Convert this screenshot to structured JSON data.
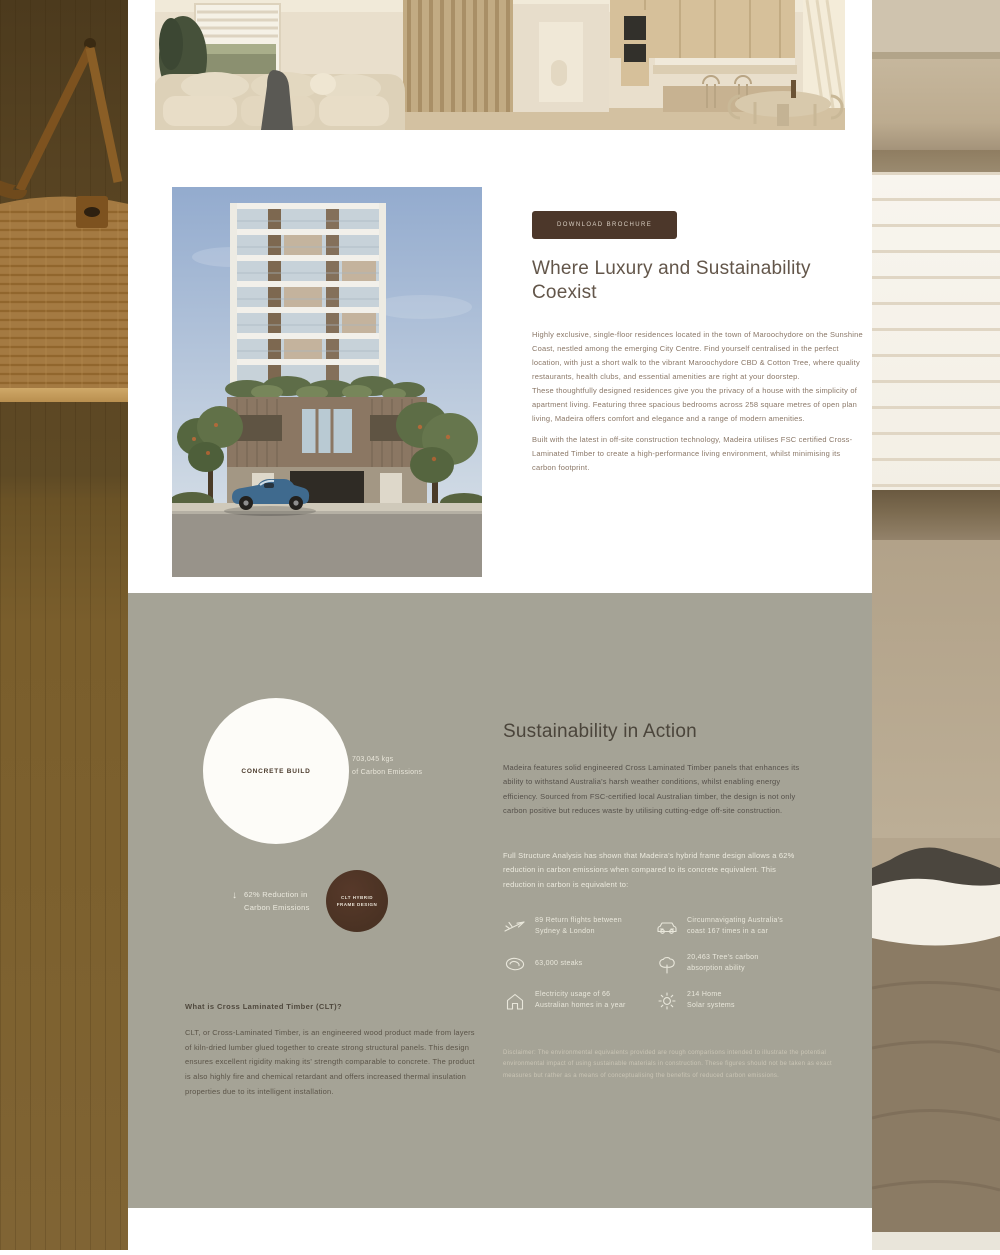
{
  "intro": {
    "button_label": "DOWNLOAD BROCHURE",
    "heading": "Where Luxury and Sustainability Coexist",
    "paragraphs": [
      "Highly exclusive, single-floor residences located in the town of Maroochydore on the Sunshine Coast, nestled among the emerging City Centre. Find yourself centralised in the perfect location, with just a short walk to the vibrant Maroochydore CBD & Cotton Tree, where quality restaurants, health clubs, and essential amenities are right at your doorstep.",
      "These thoughtfully designed residences give you the privacy of a house with the simplicity of apartment living. Featuring three spacious bedrooms across 258 square metres of open plan living, Madeira offers comfort and elegance and a range of modern amenities.",
      "Built with the latest in off-site construction technology, Madeira utilises FSC certified Cross-Laminated Timber to create a high-performance living environment, whilst minimising its carbon footprint."
    ]
  },
  "sustainability": {
    "heading": "Sustainability in Action",
    "intro": "Madeira features solid engineered Cross Laminated Timber panels that enhances its ability to withstand Australia's harsh weather conditions, whilst enabling energy efficiency. Sourced from FSC-certified local Australian timber, the design is not only carbon positive but reduces waste by utilising cutting-edge off-site construction.",
    "analysis": "Full Structure Analysis has shown that Madeira's hybrid frame design allows a 62% reduction in carbon emissions when compared to its concrete equivalent. This reduction in carbon is equivalent to:",
    "chart": {
      "concrete_label": "CONCRETE BUILD",
      "concrete_value": "703,045 kgs\nof Carbon Emissions",
      "clt_label": "CLT HYBRID\nFRAME DESIGN",
      "reduction_arrow": "↓",
      "reduction_label": "62% Reduction in\nCarbon Emissions"
    },
    "stats": [
      {
        "icon": "airplane-icon",
        "text": "89 Return flights between\nSydney & London"
      },
      {
        "icon": "car-icon",
        "text": "Circumnavigating Australia's\ncoast 167 times in a car"
      },
      {
        "icon": "steak-icon",
        "text": "63,000 steaks"
      },
      {
        "icon": "tree-icon",
        "text": "20,463 Tree's carbon\nabsorption ability"
      },
      {
        "icon": "house-icon",
        "text": "Electricity usage of 66\nAustralian homes in a year"
      },
      {
        "icon": "solar-icon",
        "text": "214 Home\nSolar systems"
      }
    ],
    "disclaimer": "Disclaimer: The environmental equivalents provided are rough comparisons intended to illustrate the potential environmental impact of using sustainable materials in construction. These figures should not be taken as exact measures but rather as a means of conceptualising the benefits of reduced carbon emissions.",
    "clt_info": {
      "heading": "What is Cross Laminated Timber (CLT)?",
      "body": "CLT, or Cross-Laminated Timber, is an engineered wood product made from layers of kiln-dried lumber glued together to create strong structural panels. This design ensures excellent rigidity making its' strength comparable to concrete. The product is also highly fire and chemical retardant and offers increased thermal insulation properties due to its intelligent installation."
    }
  },
  "colors": {
    "accent_brown": "#4C372A",
    "sage_background": "#A5A396",
    "heading_brown": "#63564A",
    "body_text_brown": "#8A7767",
    "light_text": "#E9E7DB",
    "circle_white": "#FDFCF8",
    "circle_dark_brown": "#4A3223"
  }
}
